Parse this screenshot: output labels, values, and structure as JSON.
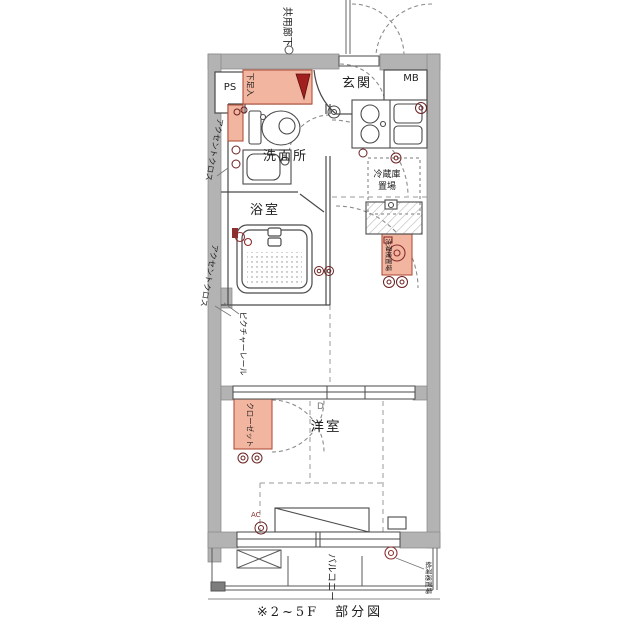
{
  "caption": "※2~5F　部分図",
  "labels": {
    "common_corridor": "共用廊下",
    "ps": "PS",
    "shoe_box": "下足入",
    "entrance": "玄関",
    "meter_box": "MB",
    "accent_cloth": "アクセントクロス",
    "washroom": "洗面所",
    "bathroom": "浴室",
    "refrigerator_line1": "冷蔵庫",
    "refrigerator_line2": "置場",
    "washer_place": "洗濯機置場",
    "picture_rail": "ピクチャーレール",
    "closet": "クローゼット",
    "western_room": "洋室",
    "d_mark": "D",
    "ac_unit": "AC",
    "balcony": "バルコニー",
    "water_heater": "給湯器置場"
  },
  "colors": {
    "wall_gray": "#b3b3b3",
    "accent_pink": "#f2b5a0",
    "accent_pink_border": "#b2503c",
    "fixture_red": "#8b2f2f",
    "line": "#4a4a4a"
  }
}
